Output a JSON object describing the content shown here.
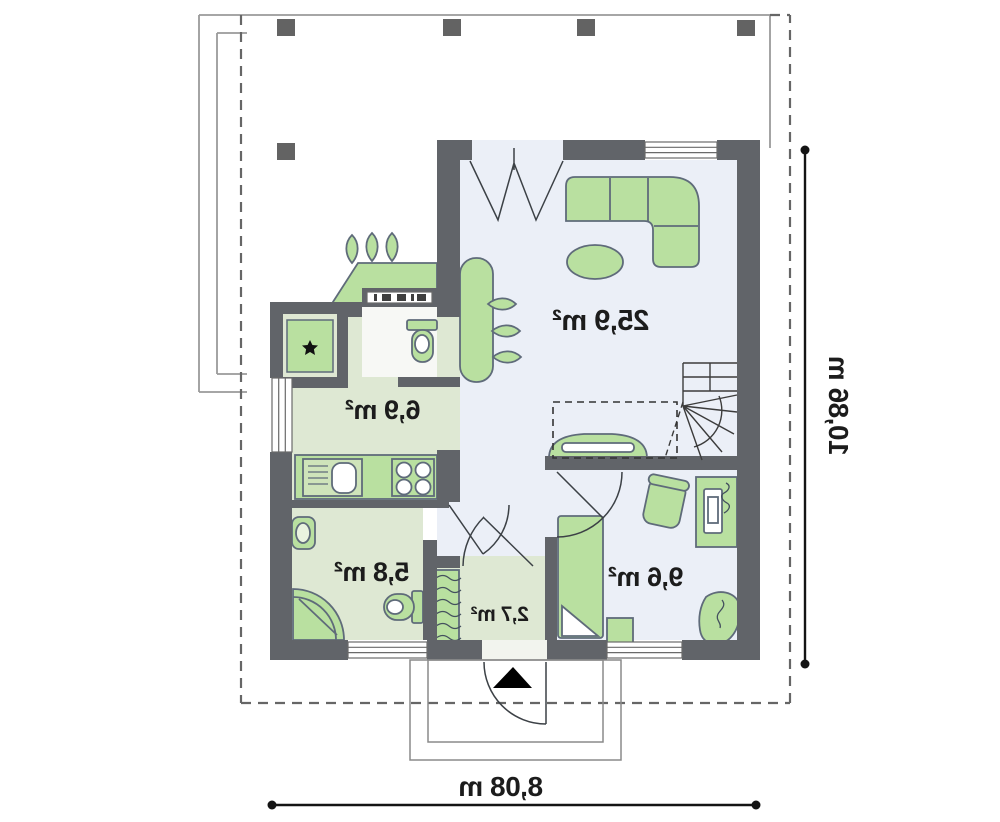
{
  "rooms": {
    "living": "25,9 m²",
    "kitchen": "6,9 m²",
    "bathroom": "5,8 m²",
    "vestibule": "2,7 m²",
    "bedroom": "9,6 m²"
  },
  "dimensions": {
    "width": "8,08 m",
    "height": "10,86 m"
  },
  "colors": {
    "wall": "#616469",
    "furniture_green": "#b9e0a0",
    "furniture_outline": "#5f6b7a",
    "floor_cool": "#ebeff7",
    "floor_green": "#dee8d3",
    "dimension_line": "#141414"
  }
}
